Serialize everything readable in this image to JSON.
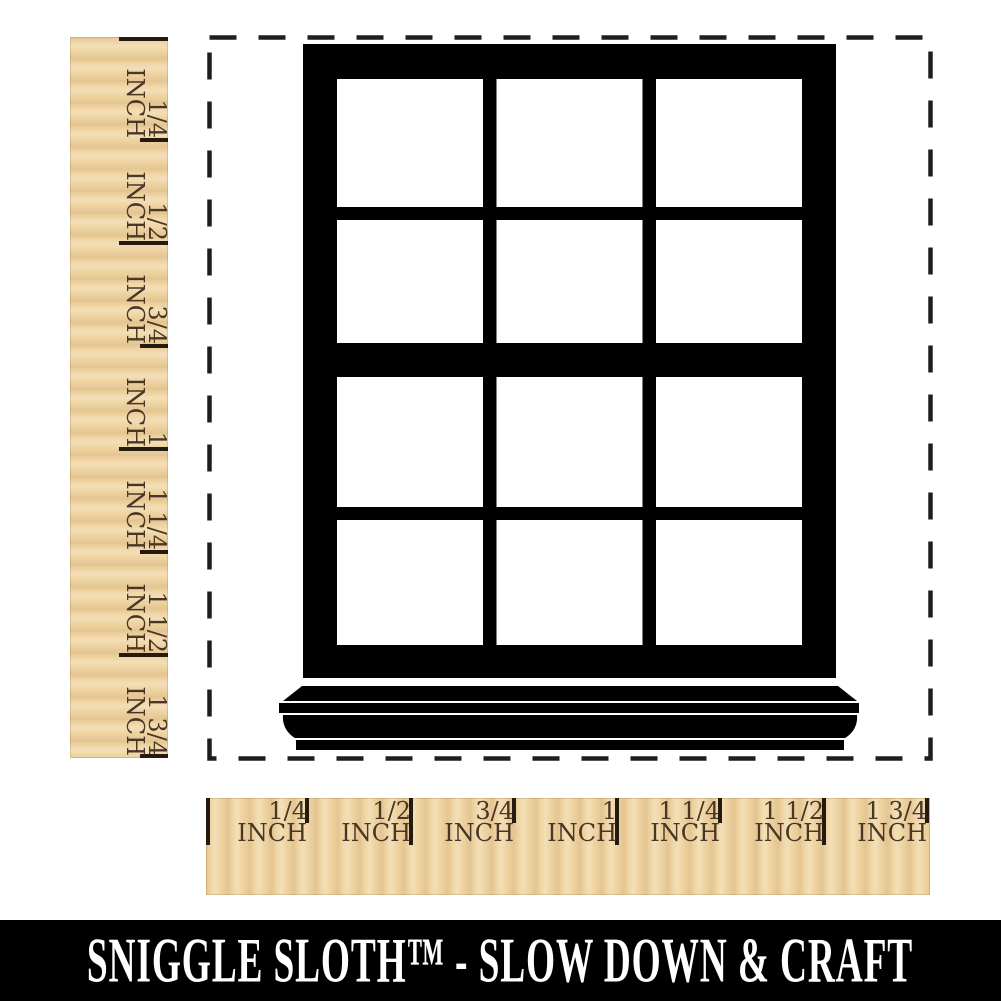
{
  "stamp": {
    "design": "twelve-pane double-hung window with sill",
    "pane_columns": 3,
    "pane_rows": 4,
    "outline": "dashed square stamp boundary"
  },
  "left_ruler": {
    "orientation": "vertical",
    "labels": [
      {
        "fraction": "1/4",
        "unit": "INCH"
      },
      {
        "fraction": "1/2",
        "unit": "INCH"
      },
      {
        "fraction": "3/4",
        "unit": "INCH"
      },
      {
        "fraction": "1",
        "unit": "INCH"
      },
      {
        "fraction": "1 1/4",
        "unit": "INCH"
      },
      {
        "fraction": "1 1/2",
        "unit": "INCH"
      },
      {
        "fraction": "1 3/4",
        "unit": "INCH"
      }
    ]
  },
  "bottom_ruler": {
    "orientation": "horizontal",
    "labels": [
      {
        "fraction": "1/4",
        "unit": "INCH"
      },
      {
        "fraction": "1/2",
        "unit": "INCH"
      },
      {
        "fraction": "3/4",
        "unit": "INCH"
      },
      {
        "fraction": "1",
        "unit": "INCH"
      },
      {
        "fraction": "1 1/4",
        "unit": "INCH"
      },
      {
        "fraction": "1 1/2",
        "unit": "INCH"
      },
      {
        "fraction": "1 3/4",
        "unit": "INCH"
      }
    ]
  },
  "banner": {
    "text": "SNIGGLE SLOTH™ - SLOW DOWN & CRAFT"
  },
  "colors": {
    "wood": "#eed3a1",
    "ruler_text": "#4a3624",
    "tick": "#241a10",
    "ink": "#000000",
    "dash": "#1e1e1e",
    "banner_bg": "#000000",
    "banner_text": "#ffffff"
  }
}
